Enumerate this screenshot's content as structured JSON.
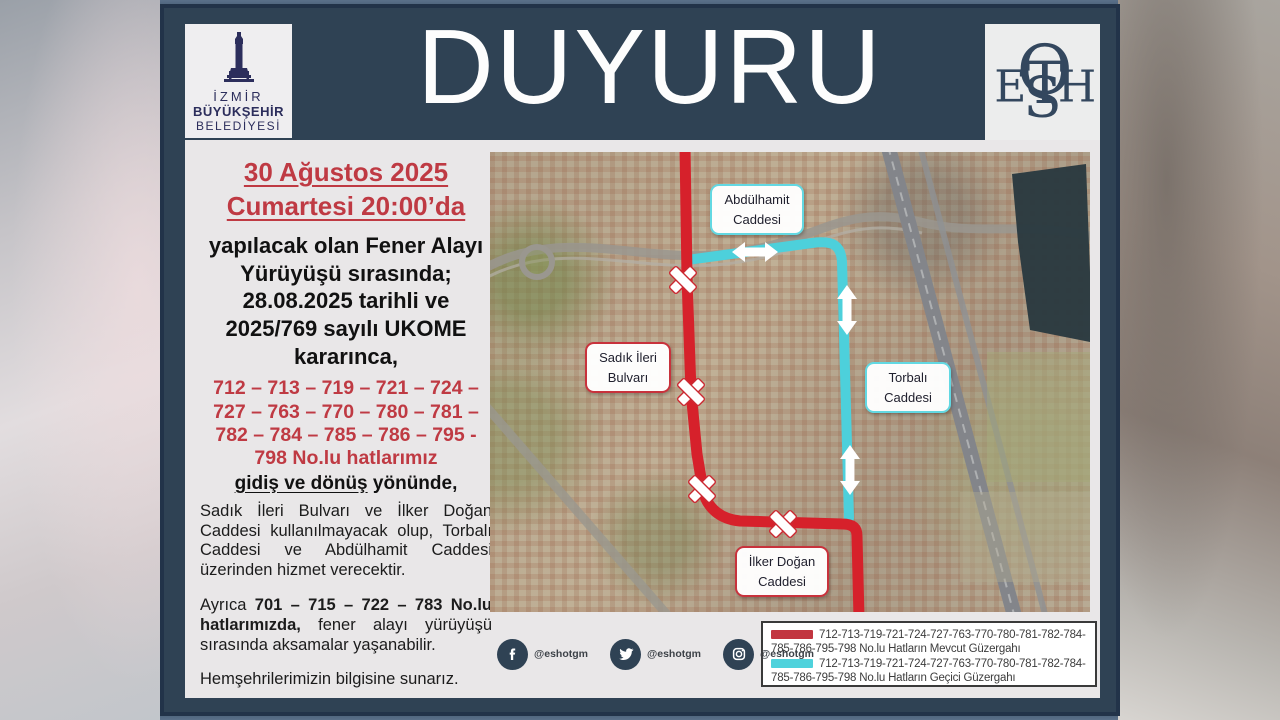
{
  "header": {
    "title": "DUYURU",
    "izmir_logo": {
      "line1": "İZMİR",
      "line2": "BÜYÜKŞEHİR",
      "line3": "BELEDİYESİ"
    },
    "eshot_monogram": [
      "E",
      "S",
      "H",
      "O",
      "T"
    ]
  },
  "announcement": {
    "date_line1": "30 Ağustos 2025",
    "date_line2": "Cumartesi 20:00’da",
    "intro": "yapılacak olan Fener Alayı Yürüyüşü sırasında; 28.08.2025 tarihli ve 2025/769 sayılı UKOME kararınca,",
    "routes_red": "712 – 713 – 719 – 721 – 724 – 727 – 763 – 770 – 780 – 781 – 782 – 784 – 785 – 786 – 795 - 798 No.lu hatlarımız",
    "direction_underlined": "gidiş ve dönüş",
    "direction_rest": " yönünde,",
    "body1": "Sadık İleri Bulvarı ve İlker Doğan Caddesi kullanılmayacak olup, Torbalı Caddesi ve Abdülhamit Caddesi üzerinden hizmet verecektir.",
    "body2_prefix": "Ayrıca ",
    "body2_routes": "701 – 715 – 722 – 783 No.lu hatlarımızda,",
    "body2_rest": " fener alayı yürüyüşü sırasında aksamalar yaşanabilir.",
    "closing": "Hemşehrilerimizin bilgisine sunarız."
  },
  "map": {
    "labels": [
      {
        "line1": "Abdülhamit",
        "line2": "Caddesi",
        "style": "temporary"
      },
      {
        "line1": "Sadık İleri",
        "line2": "Bulvarı",
        "style": "closed"
      },
      {
        "line1": "Torbalı",
        "line2": "Caddesi",
        "style": "temporary"
      },
      {
        "line1": "İlker Doğan",
        "line2": "Caddesi",
        "style": "closed"
      }
    ]
  },
  "legend": {
    "entries": [
      {
        "color": "#c23540",
        "label": "712-713-719-721-724-727-763-770-780-781-782-784-785-786-795-798 No.lu Hatların Mevcut Güzergahı"
      },
      {
        "color": "#4fd2dc",
        "label": "712-713-719-721-724-727-763-770-780-781-782-784-785-786-795-798 No.lu Hatların Geçici Güzergahı"
      }
    ]
  },
  "social": {
    "facebook_handle": "@eshotgm",
    "twitter_handle": "@eshotgm",
    "instagram_handle": "@eshotgm"
  },
  "colors": {
    "route_current": "#d6212b",
    "route_temporary": "#4fd2dc",
    "poster_navy": "#2f4254",
    "accent_red_text": "#bf3a43"
  }
}
